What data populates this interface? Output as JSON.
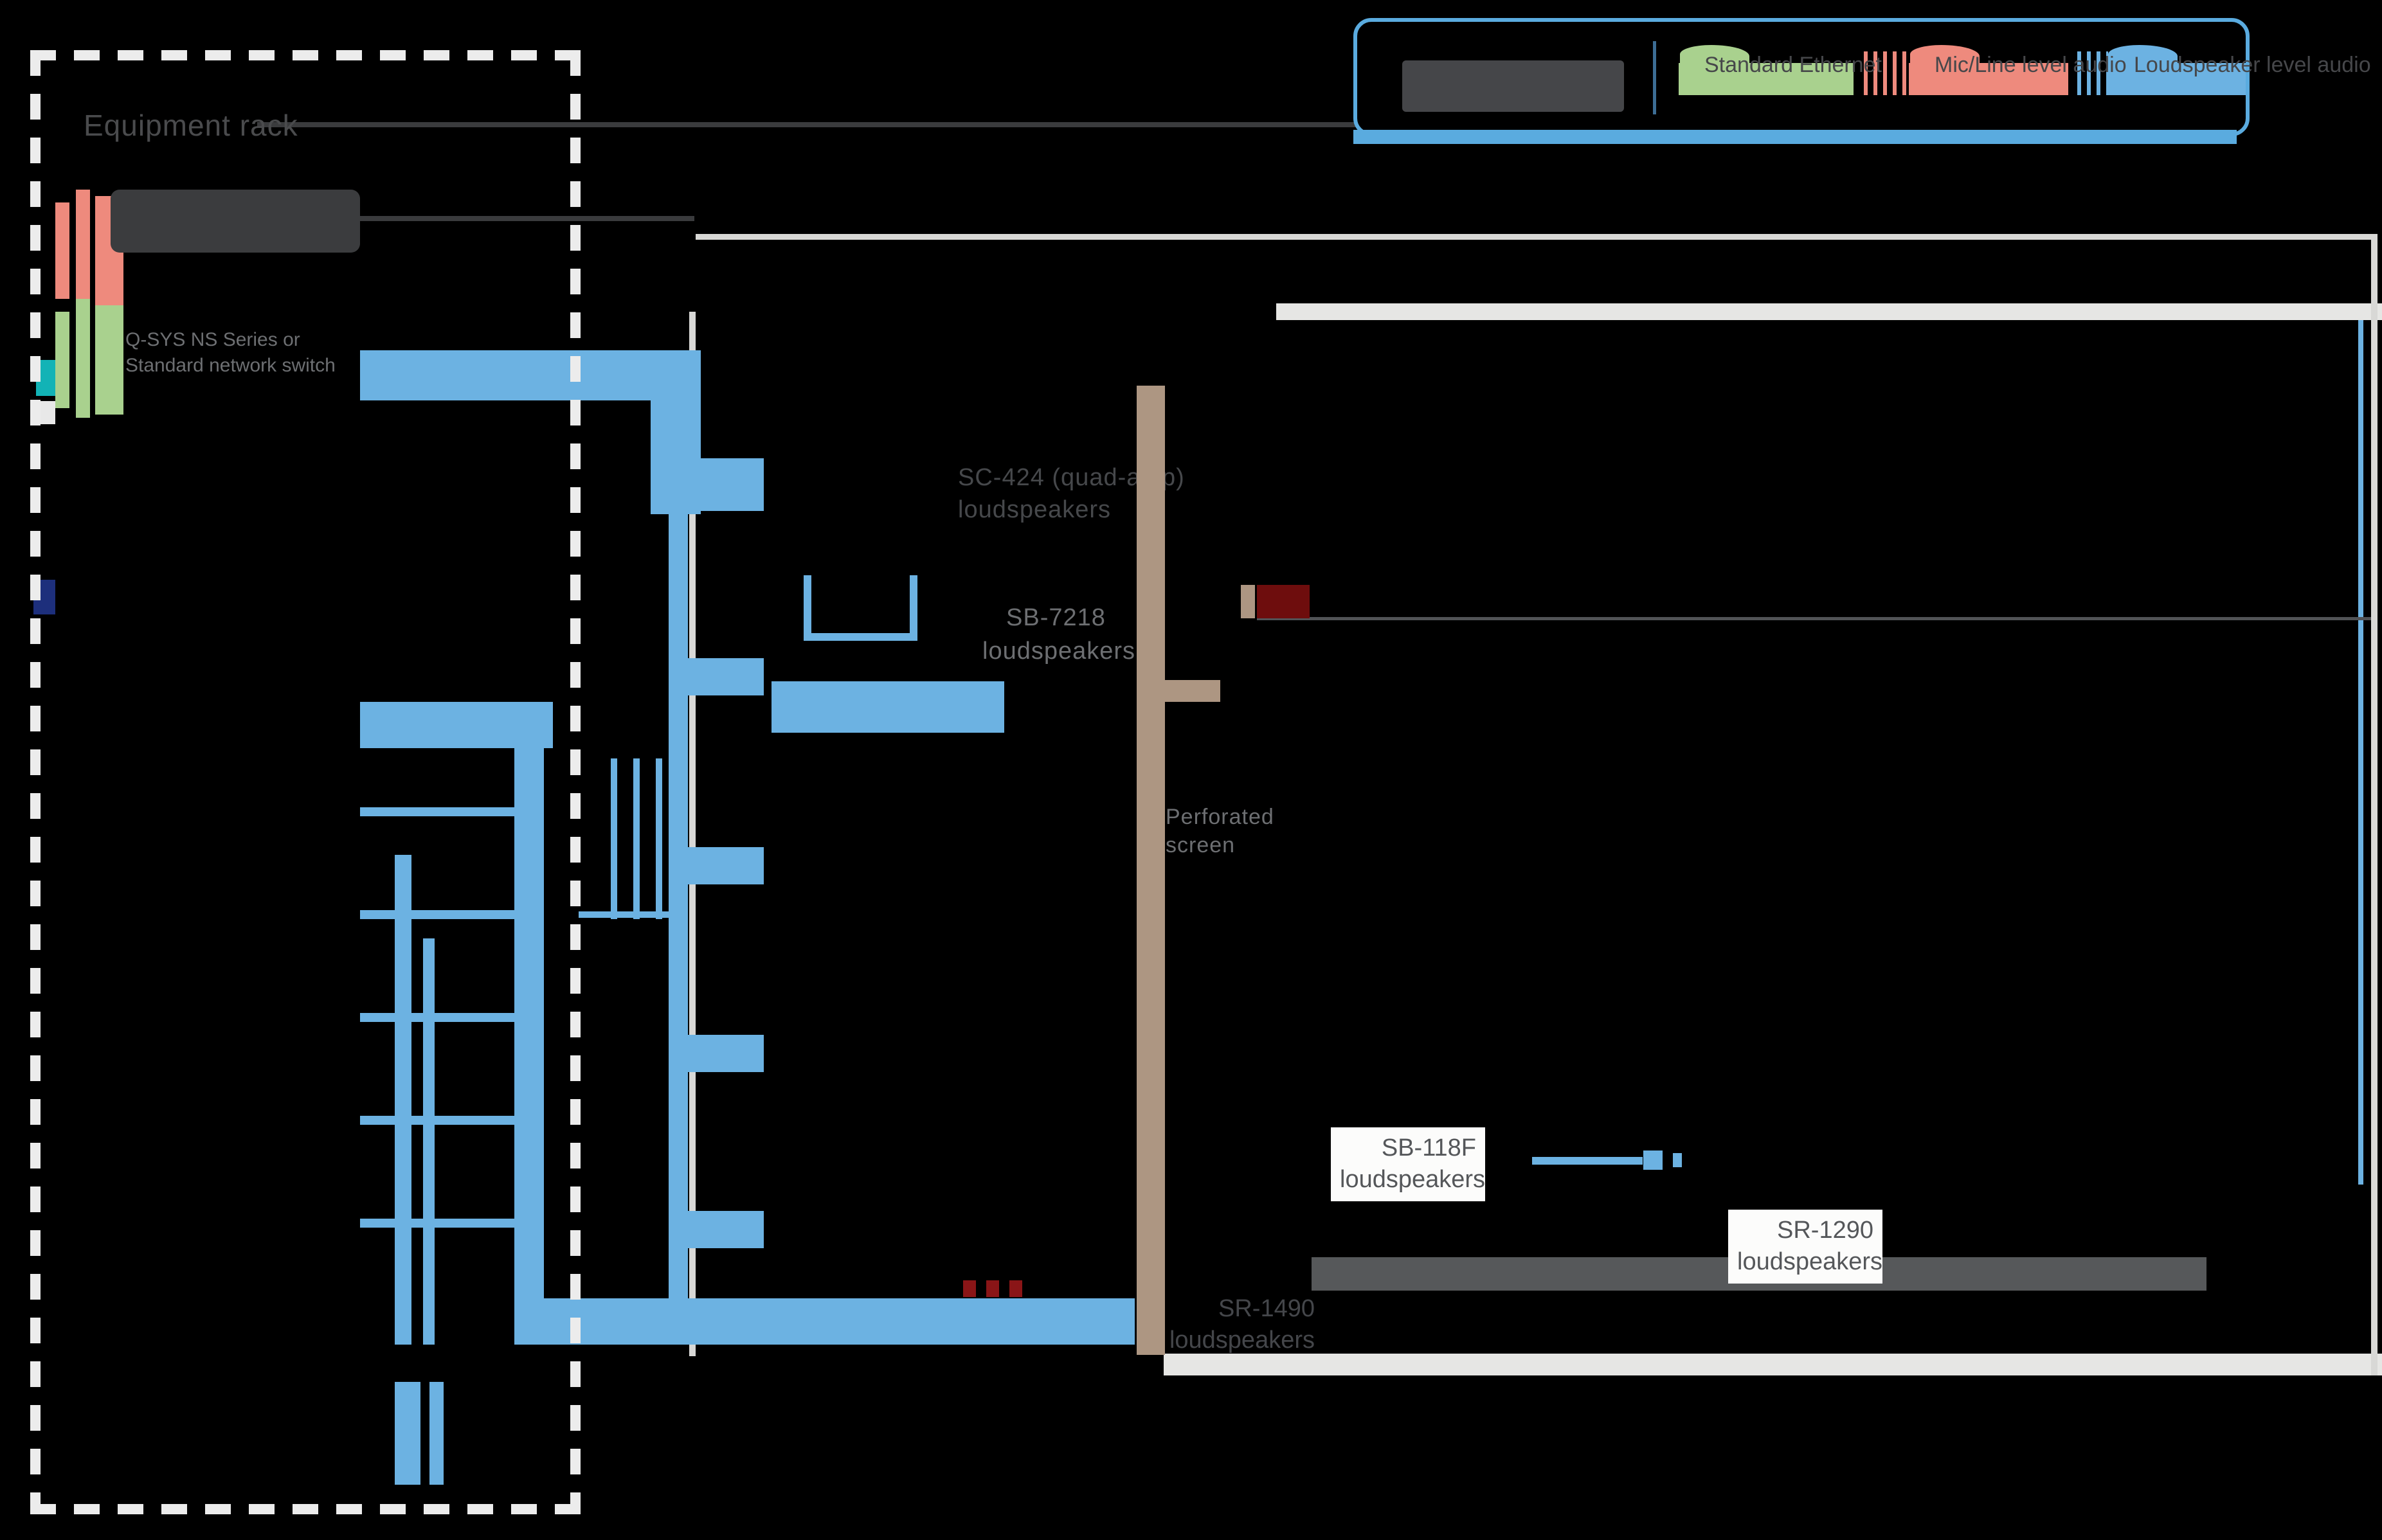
{
  "legend": {
    "entries": [
      {
        "label": "Standard Ethernet",
        "color": "#a9d18e"
      },
      {
        "label": "Mic/Line level audio",
        "color": "#ee8a7d"
      },
      {
        "label": "Loudspeaker level audio",
        "color": "#6cb2e2"
      }
    ]
  },
  "rack": {
    "title": "Equipment rack",
    "core_brand": "Q-SYS",
    "switch_brand": "Q-SYS",
    "switch_label_line1": "Q-SYS NS Series or",
    "switch_label_line2": "Standard network switch",
    "amp_brand": "Q-SYS",
    "devices": [
      {
        "type": "dca",
        "label": ""
      },
      {
        "type": "dca",
        "label": "DCA 1222 (Right Center HF/VHF)"
      },
      {
        "type": "dca",
        "label": "DCA 1222 (Center HF/VHF)"
      },
      {
        "type": "dca",
        "label": "DCA 1222 (Left HF/VHF)"
      },
      {
        "type": "cxq",
        "label": "CX-Q 8-channel (Right LF/MF, Sub 1, LRS-1, LRS-2)"
      },
      {
        "type": "cxq",
        "label": "CX-Q 8-channel (Right Center LF/MF, Sub 2, Arch 9)"
      },
      {
        "type": "cxq",
        "label": "CX-Q 8-channel (Center LF/MF, Arch 5)"
      },
      {
        "type": "cxq",
        "label": "CX-Q 8-channel (Left Center LF/MF, Sub 3, Arch 3)"
      },
      {
        "type": "cxq",
        "label": "CX-Q 8-channel(Left LF/MF, Sub 4, LFE, RRS-1, RRS-2)"
      },
      {
        "type": "cxq",
        "label": "CX-Q 8-channel (Arch 2, 6)"
      },
      {
        "type": "cxq",
        "label": "CX-Q 8-channel (Arch 8, Arch 4)"
      }
    ]
  },
  "stage_labels": {
    "sc424_line1": "SC-424 (quad-amp)",
    "sc424_line2": "loudspeakers",
    "sb7218_line1": "SB-7218",
    "sb7218_line2": "loudspeakers",
    "screen_line1": "Perforated",
    "screen_line2": "screen"
  },
  "auditorium": {
    "arch_labels": [
      "Arch 1",
      "Arch 2",
      "Arch 3",
      "Arch 4",
      "Arch 5",
      "Arch 6",
      "Arch 7",
      "Arch 8",
      "Arch 9"
    ],
    "sb118f_line1": "SB-118F",
    "sb118f_line2": "loudspeakers",
    "sr1290_line1": "SR-1290",
    "sr1290_line2": "loudspeakers",
    "rear_line1": "SR-1490",
    "rear_line2": "loudspeakers"
  },
  "colors": {
    "accent_blue": "#5aabdf",
    "cable_blue": "#6cb2e2",
    "ethernet_green": "#a9d18e",
    "mic_red": "#ee8a7d",
    "teal_block": "#0f6b74",
    "tan_screen": "#ad9682"
  }
}
